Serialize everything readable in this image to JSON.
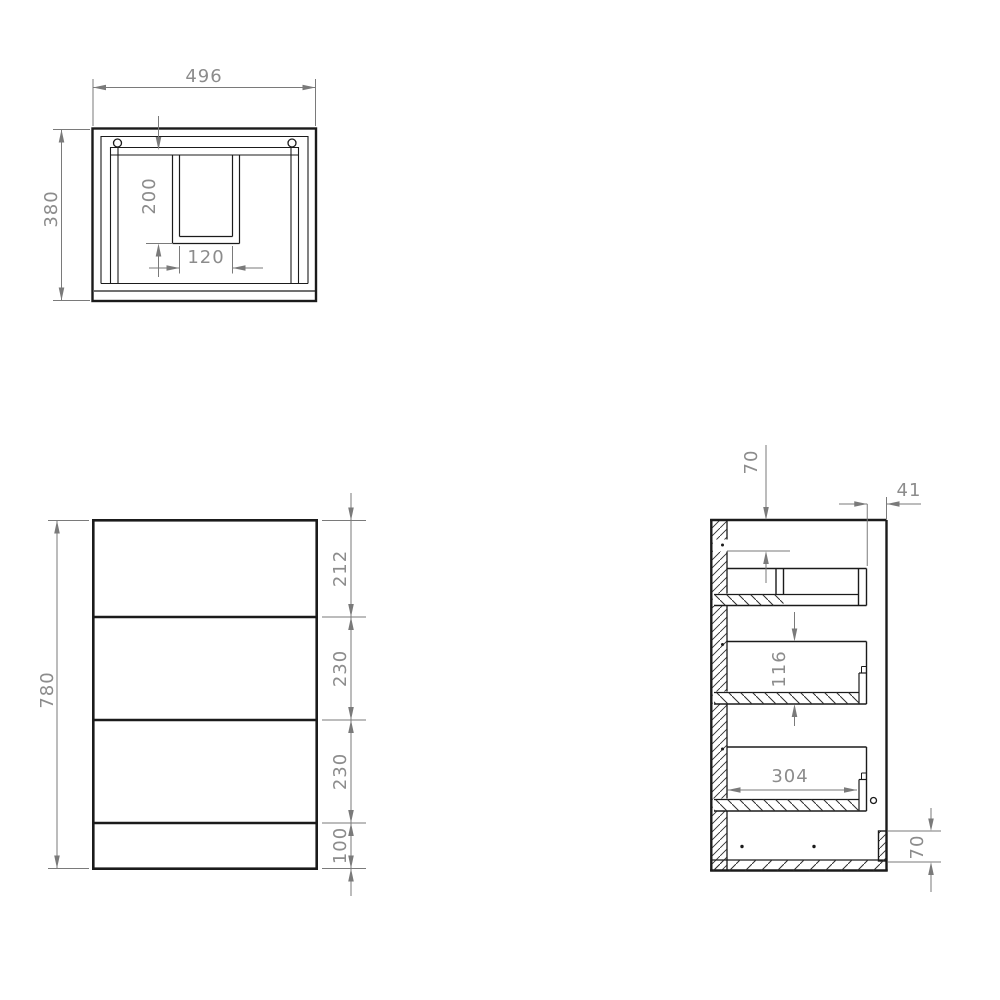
{
  "document": {
    "kind": "technical-drawing",
    "background": "#ffffff",
    "colors": {
      "geometry": "#1b1b1b",
      "thin_geometry": "#2a2a2a",
      "hatch": "#2e2e2e",
      "dimension_line": "#7a7a7a",
      "dimension_text": "#8c8c8c"
    }
  },
  "views": {
    "top": {
      "name": "plan-view",
      "width": "496",
      "depth": "380",
      "cutout_depth": "200",
      "cutout_width": "120"
    },
    "front": {
      "name": "front-view",
      "height": "780",
      "segments": [
        "212",
        "230",
        "230",
        "100"
      ]
    },
    "side": {
      "name": "side-section-view",
      "top_clearance": "70",
      "front_inset": "41",
      "drawer_depth": "116",
      "drawer_length": "304",
      "plinth_height": "70"
    }
  }
}
